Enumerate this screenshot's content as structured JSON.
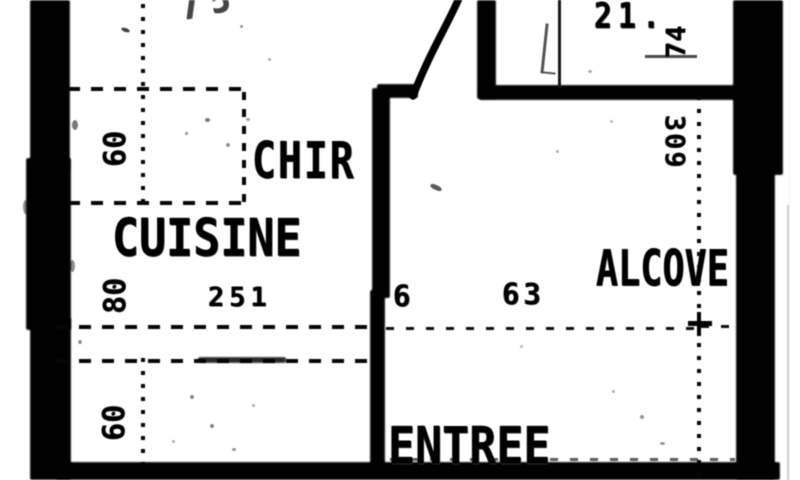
{
  "colors": {
    "paper": "#fbfbfa",
    "ink": "#161616",
    "wall": "#181818"
  },
  "plan": {
    "room_labels": {
      "cuisine": "CUISINE",
      "entree": "ENTREE",
      "upper_left": "CHIR",
      "right_room": "ALCOVE"
    },
    "dimension_labels": {
      "top_partial": "75",
      "closet_width": "21.",
      "closet_depth": "74",
      "right_height": "309",
      "left_top": "60",
      "left_mid": "80",
      "left_bottom": "60",
      "kitchen_width": "251",
      "entry_a": "6",
      "entry_b": "63"
    }
  }
}
